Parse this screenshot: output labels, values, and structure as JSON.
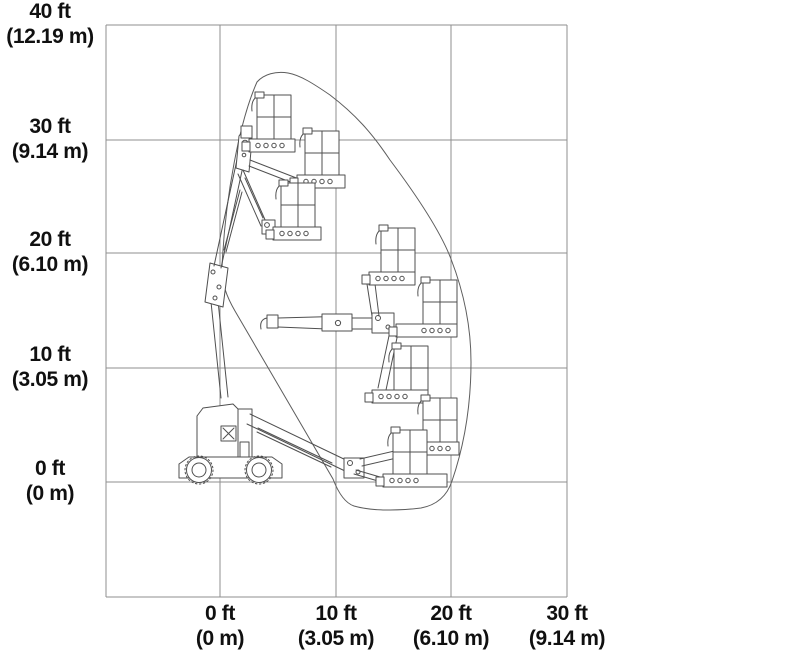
{
  "figure": {
    "kind": "working-envelope reach diagram",
    "machine": "articulated boom lift with jib platform (7 platform positions shown)",
    "colors": {
      "background": "#ffffff",
      "grid": "#8f8f8f",
      "linework": "#4f4f4f",
      "label": "#101010"
    },
    "y_axis": {
      "ticks": [
        {
          "ft": "40 ft",
          "m": "(12.19 m)"
        },
        {
          "ft": "30 ft",
          "m": "(9.14 m)"
        },
        {
          "ft": "20 ft",
          "m": "(6.10 m)"
        },
        {
          "ft": "10 ft",
          "m": "(3.05 m)"
        },
        {
          "ft": "0 ft",
          "m": "(0 m)"
        }
      ]
    },
    "x_axis": {
      "ticks": [
        {
          "ft": "0 ft",
          "m": "(0 m)"
        },
        {
          "ft": "10 ft",
          "m": "(3.05 m)"
        },
        {
          "ft": "20 ft",
          "m": "(6.10 m)"
        },
        {
          "ft": "30 ft",
          "m": "(9.14 m)"
        }
      ]
    }
  },
  "chart_data": {
    "type": "envelope-diagram",
    "x_axis_ticks_ft": [
      0,
      10,
      20,
      30
    ],
    "y_axis_ticks_ft": [
      0,
      10,
      20,
      30,
      40
    ],
    "x_axis_ticks_m": [
      0,
      3.05,
      6.1,
      9.14
    ],
    "y_axis_ticks_m": [
      0,
      3.05,
      6.1,
      9.14,
      12.19
    ],
    "grid": "on",
    "platform_positions_count": 7,
    "envelope_outline_ft": [
      [
        0.2,
        18.7
      ],
      [
        3.2,
        35.0
      ],
      [
        5.9,
        35.8
      ],
      [
        9.5,
        33.8
      ],
      [
        14.7,
        28.1
      ],
      [
        20.0,
        19.5
      ],
      [
        21.8,
        10.5
      ],
      [
        20.1,
        0.1
      ],
      [
        17.4,
        -2.3
      ],
      [
        11.6,
        -2.1
      ],
      [
        9.8,
        0.3
      ],
      [
        1.3,
        14.9
      ]
    ]
  }
}
